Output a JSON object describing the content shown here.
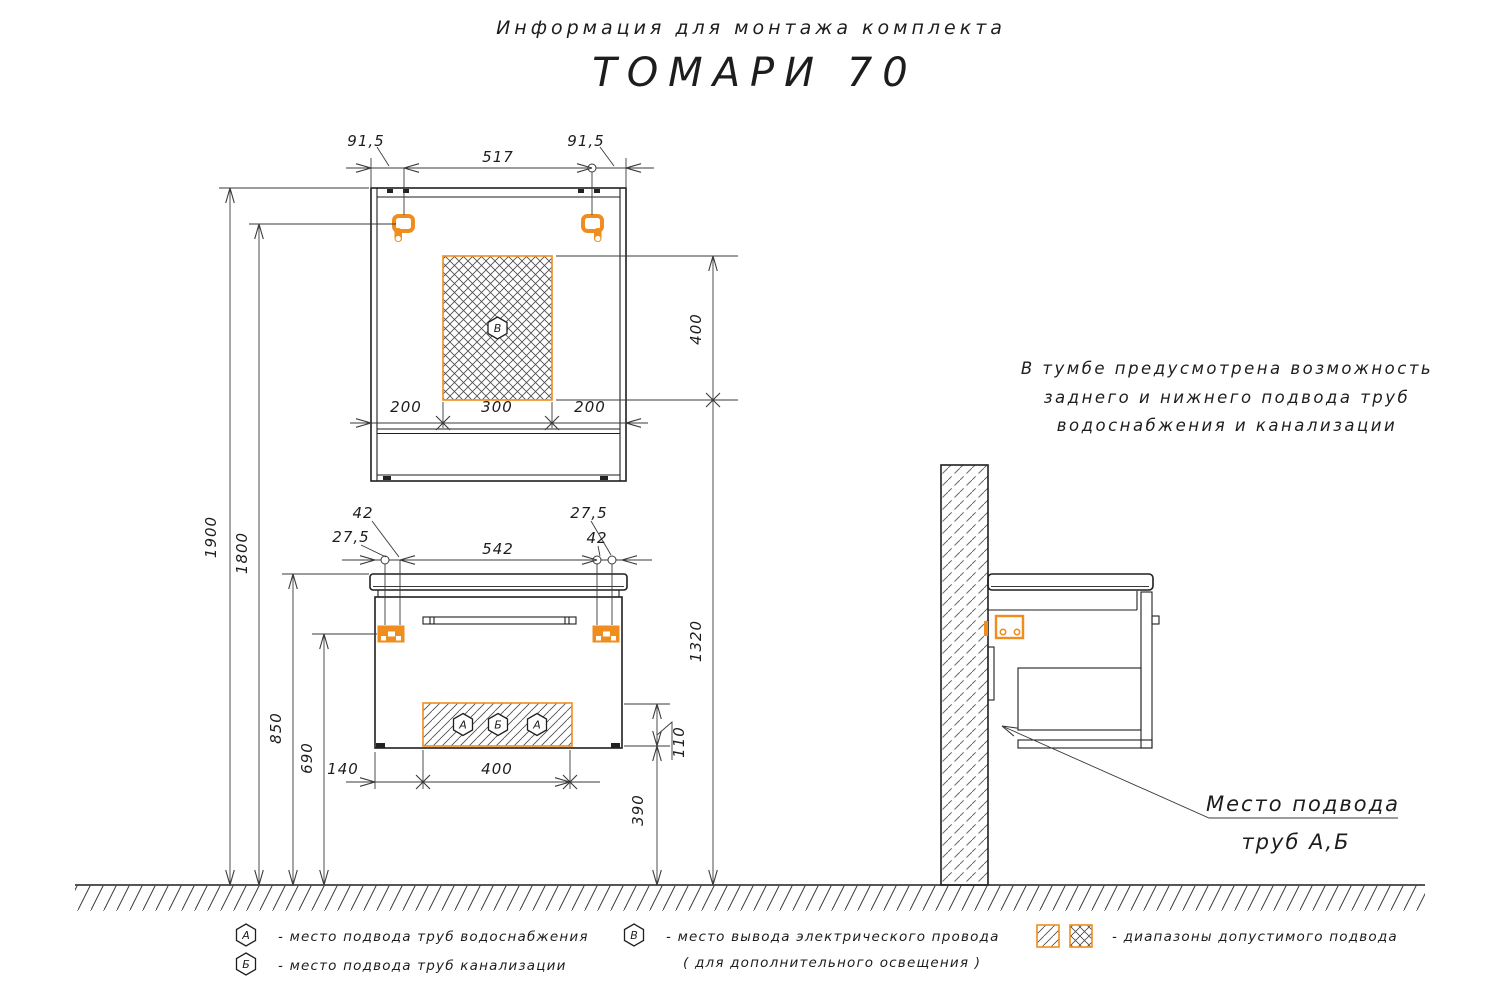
{
  "colors": {
    "accent": "#EF8E1E",
    "line": "#1f1f1f",
    "dim": "#3a3a3a"
  },
  "title": {
    "subtitle": "Информация для монтажа комплекта",
    "model": "ТОМАРИ 70"
  },
  "note": {
    "line1": "В тумбе предусмотрена возможность",
    "line2": "заднего и нижнего подвода труб",
    "line3": "водоснабжения и канализации"
  },
  "callout": {
    "line1": "Место подвода",
    "line2": "труб А,Б"
  },
  "mirror": {
    "dim_left": "91,5",
    "dim_span": "517",
    "dim_right": "91,5",
    "dim_b_left": "200",
    "dim_b_center": "300",
    "dim_b_right": "200",
    "dim_hatch_h": "400",
    "hex": "В"
  },
  "vanity": {
    "dim_l1": "42",
    "dim_l2": "27,5",
    "dim_span": "542",
    "dim_r1": "27,5",
    "dim_r2": "42",
    "dim_w1": "140",
    "dim_w2": "400",
    "hex1": "А",
    "hex2": "Б",
    "hex3": "А",
    "dim_h110": "110",
    "dim_h390": "390",
    "dim_h1320": "1320"
  },
  "heights": {
    "h1900": "1900",
    "h1800": "1800",
    "h850": "850",
    "h690": "690"
  },
  "legend": {
    "a_sym": "А",
    "a_text": "-  место подвода труб водоснабжения",
    "b_sym": "Б",
    "b_text": "-  место подвода труб канализации",
    "v_sym": "В",
    "v_text1": "-  место вывода электрического провода",
    "v_text2": "( для дополнительного освещения )",
    "swatch_text": "-  диапазоны допустимого подвода"
  }
}
